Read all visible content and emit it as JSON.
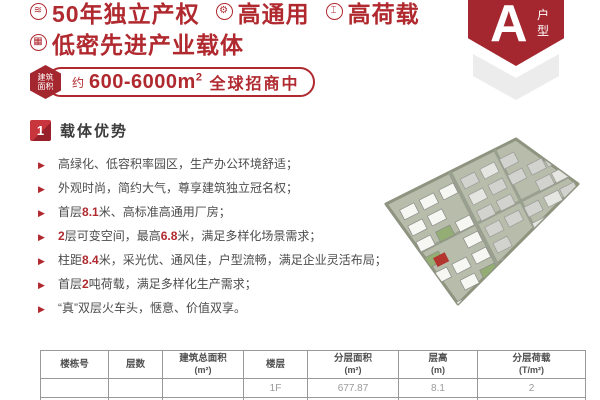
{
  "theme": {
    "red": "#B0292F",
    "badge_red": "#A4262E",
    "dark_text": "#4C4C4C",
    "chevron_gray": "#ECECEC",
    "map_base": "#B7BCAB",
    "map_highlight": "#B23530",
    "bullet_icon": "▶"
  },
  "header": {
    "features_line1": [
      {
        "icon": "layers-icon",
        "glyph": "≋",
        "label": "50年独立产权"
      },
      {
        "icon": "gear-icon",
        "glyph": "⚙",
        "label": "高通用"
      },
      {
        "icon": "weight-icon",
        "glyph": "⌶",
        "label": "高荷载"
      }
    ],
    "features_line2": [
      {
        "icon": "building-icon",
        "glyph": "▦",
        "label": "低密先进产业载体"
      }
    ],
    "area_pill": {
      "badge_line1": "建筑",
      "badge_line2": "面积",
      "prefix": "约",
      "range": "600-6000m",
      "sup": "2",
      "suffix": "全球招商中"
    },
    "type_badge": {
      "letter": "A",
      "label_char1": "户",
      "label_char2": "型"
    }
  },
  "section": {
    "number": "1",
    "title": "载体优势"
  },
  "bullets": [
    {
      "segments": [
        {
          "t": "高绿化、低容积率园区，生产办公环境舒适；"
        }
      ]
    },
    {
      "segments": [
        {
          "t": "外观时尚，简约大气，尊享建筑独立冠名权；"
        }
      ]
    },
    {
      "segments": [
        {
          "t": "首层"
        },
        {
          "t": "8.1",
          "em": true
        },
        {
          "t": "米、高标准高通用厂房；"
        }
      ]
    },
    {
      "segments": [
        {
          "t": "2",
          "em": true
        },
        {
          "t": "层可变空间，最高"
        },
        {
          "t": "6.8",
          "em": true
        },
        {
          "t": "米，满足多样化场景需求；"
        }
      ]
    },
    {
      "segments": [
        {
          "t": "柱距"
        },
        {
          "t": "8.4",
          "em": true
        },
        {
          "t": "米，采光优、通风佳，户型流畅，满足企业灵活布局；"
        }
      ]
    },
    {
      "segments": [
        {
          "t": "首层"
        },
        {
          "t": "2",
          "em": true
        },
        {
          "t": "吨荷载，满足多样化生产需求；"
        }
      ]
    },
    {
      "segments": [
        {
          "t": "“真”双层火车头，惬意、价值双享。"
        }
      ]
    }
  ],
  "table": {
    "headers": [
      {
        "title": "楼栋号",
        "unit": ""
      },
      {
        "title": "层数",
        "unit": ""
      },
      {
        "title": "建筑总面积",
        "unit": "(m²)"
      },
      {
        "title": "楼层",
        "unit": ""
      },
      {
        "title": "分层面积",
        "unit": "(m²)"
      },
      {
        "title": "层高",
        "unit": "(m)"
      },
      {
        "title": "分层荷载",
        "unit": "(T/m²)"
      }
    ],
    "col_widths": [
      68,
      54,
      81,
      64,
      91,
      79,
      108
    ],
    "rows": [
      [
        "",
        "",
        "",
        "1F",
        "677.87",
        "8.1",
        "2"
      ],
      [
        "",
        "",
        "",
        "",
        "",
        "",
        ""
      ]
    ]
  }
}
